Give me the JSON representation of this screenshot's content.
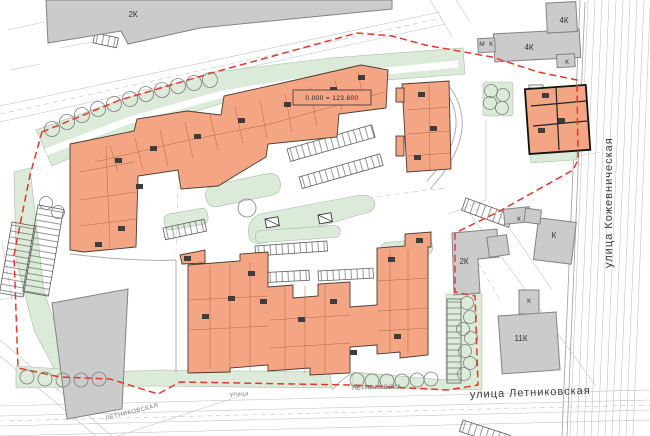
{
  "plan": {
    "datum_label": "0.000 = 123.600",
    "streets": {
      "right_vertical": "улица Кожевническая",
      "bottom_main": "улица Летниковская",
      "bottom_small": "улица",
      "bottom_left_diagonal": "ЛЕТНИКОВСКАЯ",
      "bottom_tiny": "ЛЕТНИКОВСКА"
    },
    "existing_buildings": [
      {
        "id": "north-west-2k",
        "label": "2К"
      },
      {
        "id": "north-east-4k-wing",
        "label": "4К"
      },
      {
        "id": "north-east-4k-main",
        "label": "4К"
      },
      {
        "id": "north-east-annex-m",
        "label": "М"
      },
      {
        "id": "north-east-annex-k",
        "label": "К"
      },
      {
        "id": "north-east-corner-k",
        "label": "К"
      },
      {
        "id": "east-top-k",
        "label": "К"
      },
      {
        "id": "east-big-k",
        "label": "К"
      },
      {
        "id": "east-2k",
        "label": "2К"
      },
      {
        "id": "east-small-k",
        "label": "К"
      },
      {
        "id": "east-11k",
        "label": "11К"
      }
    ],
    "legend_colors": {
      "proposed_building": "#f4a583",
      "existing_building": "#cbcbcb",
      "landscaping": "#dcead9",
      "site_boundary": "#e2392c"
    }
  }
}
